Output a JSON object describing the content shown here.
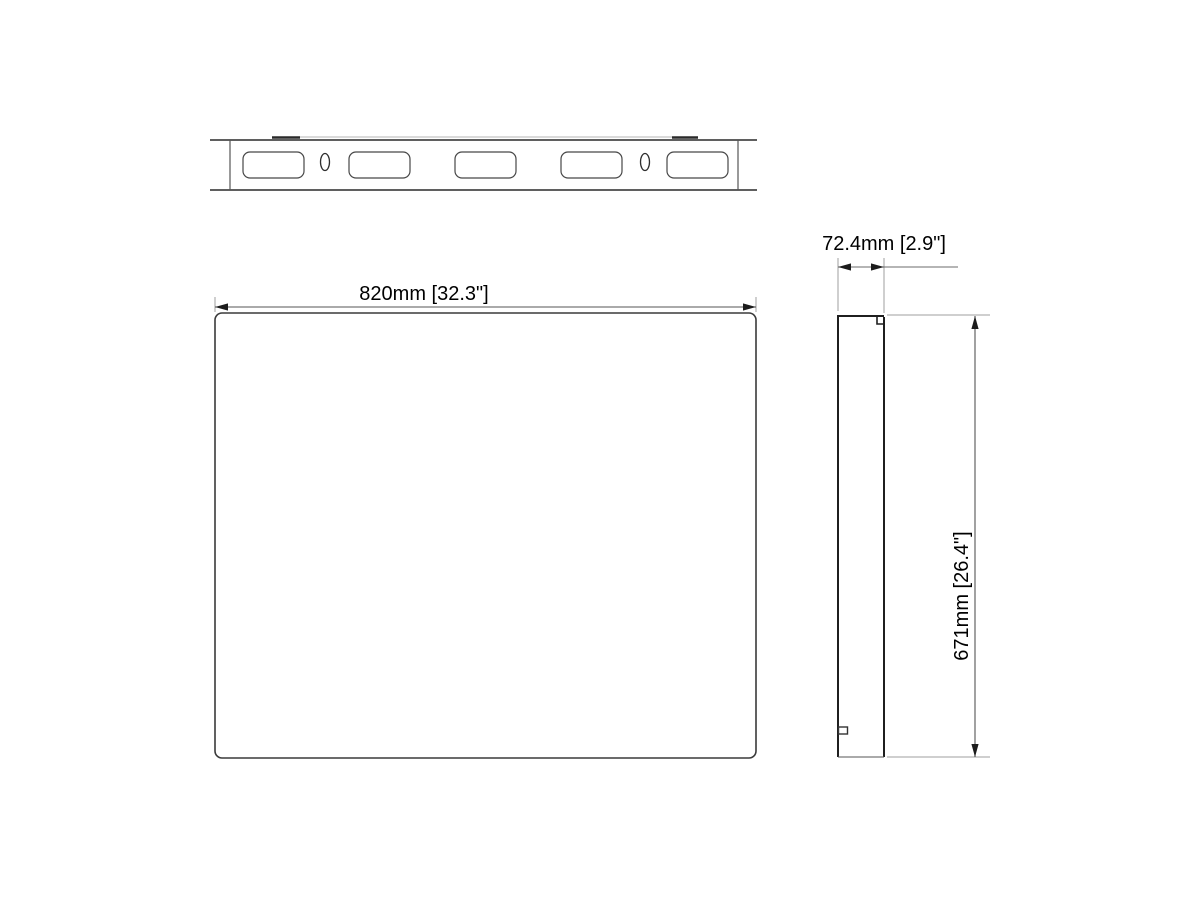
{
  "drawing": {
    "type": "technical-three-view",
    "dimensions": {
      "width_label": "820mm [32.3\"]",
      "depth_label": "72.4mm [2.9\"]",
      "height_label": "671mm [26.4\"]"
    },
    "top_view": {
      "slot_count": 5,
      "pin_hole_count": 2,
      "slots": [
        {
          "x": 243
        },
        {
          "x": 349
        },
        {
          "x": 455
        },
        {
          "x": 561
        },
        {
          "x": 667
        }
      ],
      "slot_y": 152,
      "slot_width": 61,
      "slot_height": 26,
      "slot_corner_radius": 7,
      "holes": [
        {
          "cx": 325
        },
        {
          "cx": 645
        }
      ],
      "hole_cy": 162,
      "hole_rx": 4.5,
      "hole_ry": 8.5
    },
    "colors": {
      "outline": "#2a2a2a",
      "secondary_line": "#555555",
      "dim_line": "#6b6b6b",
      "extension_line": "#9f9f9f",
      "faint_edge": "#b5b5b5",
      "text": "#000000",
      "background": "#ffffff"
    }
  }
}
